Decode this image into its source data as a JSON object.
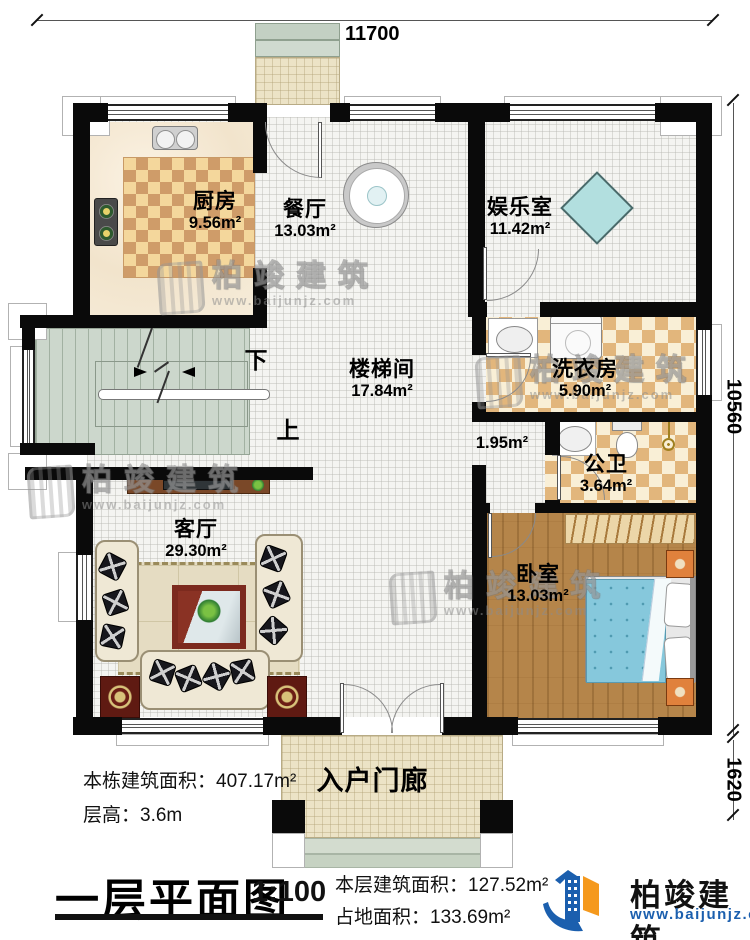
{
  "plan": {
    "title": "一层平面图",
    "scale": "1:100",
    "dimensions": {
      "top": "11700",
      "right": "10560",
      "bottom_right": "1620"
    },
    "rooms": [
      {
        "name": "厨房",
        "area": "9.56m²"
      },
      {
        "name": "餐厅",
        "area": "13.03m²"
      },
      {
        "name": "娱乐室",
        "area": "11.42m²"
      },
      {
        "name": "楼梯间",
        "area": "17.84m²"
      },
      {
        "name": "洗衣房",
        "area": "5.90m²"
      },
      {
        "name": "公卫",
        "area": "3.64m²"
      },
      {
        "name": "客厅",
        "area": "29.30m²"
      },
      {
        "name": "卧室",
        "area": "13.03m²"
      },
      {
        "name": "入户门廊",
        "area": ""
      },
      {
        "name": "",
        "area": "1.95m²"
      }
    ],
    "stairs": {
      "down": "下",
      "up": "上"
    },
    "info": [
      {
        "label": "本栋建筑面积：",
        "value": "407.17m²"
      },
      {
        "label": "层高：",
        "value": "3.6m"
      },
      {
        "label": "本层建筑面积：",
        "value": "127.52m²"
      },
      {
        "label": "占地面积：",
        "value": "133.69m²"
      }
    ]
  },
  "brand": {
    "name": "柏竣建筑",
    "website": "www.baijunjz.com"
  },
  "watermark": {
    "name": "柏竣建筑",
    "website": "www.baijunjz.com"
  },
  "colors": {
    "wall": "#0a0a0a",
    "brand_blue": "#1b5fae",
    "brand_orange": "#f5991d",
    "bed": "#86c8dc",
    "wood_floor": "#b5854a",
    "stair_floor": "#ccd7cc",
    "checker_tan": "#dfb277",
    "marble": "#f6ecd9"
  }
}
